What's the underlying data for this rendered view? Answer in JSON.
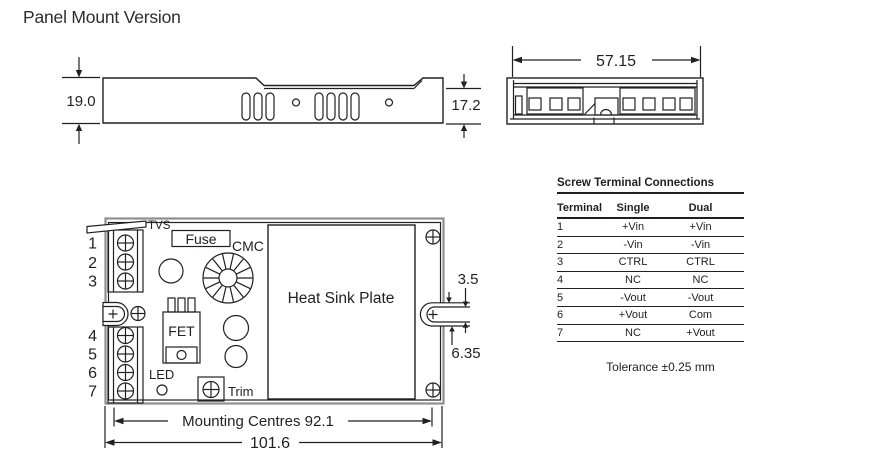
{
  "page_title": "Panel Mount Version",
  "colors": {
    "line": "#231f20",
    "case_outer": "#8f8f8f"
  },
  "side_view": {
    "height": "19.0",
    "end_height": "17.2"
  },
  "end_view": {
    "width": "57.15"
  },
  "pcb_view": {
    "labels": {
      "tvs": "TVS",
      "fuse": "Fuse",
      "cmc": "CMC",
      "fet": "FET",
      "led": "LED",
      "trim": "Trim",
      "heat_sink": "Heat Sink Plate"
    },
    "terminal_numbers": [
      "1",
      "2",
      "3",
      "4",
      "5",
      "6",
      "7"
    ],
    "dims": {
      "slot_width": "3.5",
      "slot_offset": "6.35",
      "mounting_centres": "Mounting Centres 92.1",
      "overall_width": "101.6"
    }
  },
  "table": {
    "title": "Screw Terminal Connections",
    "columns": [
      "Terminal",
      "Single",
      "Dual"
    ],
    "rows": [
      [
        "1",
        "+Vin",
        "+Vin"
      ],
      [
        "2",
        "-Vin",
        "-Vin"
      ],
      [
        "3",
        "CTRL",
        "CTRL"
      ],
      [
        "4",
        "NC",
        "NC"
      ],
      [
        "5",
        "-Vout",
        "-Vout"
      ],
      [
        "6",
        "+Vout",
        "Com"
      ],
      [
        "7",
        "NC",
        "+Vout"
      ]
    ]
  },
  "tolerance_note": "Tolerance ±0.25 mm"
}
